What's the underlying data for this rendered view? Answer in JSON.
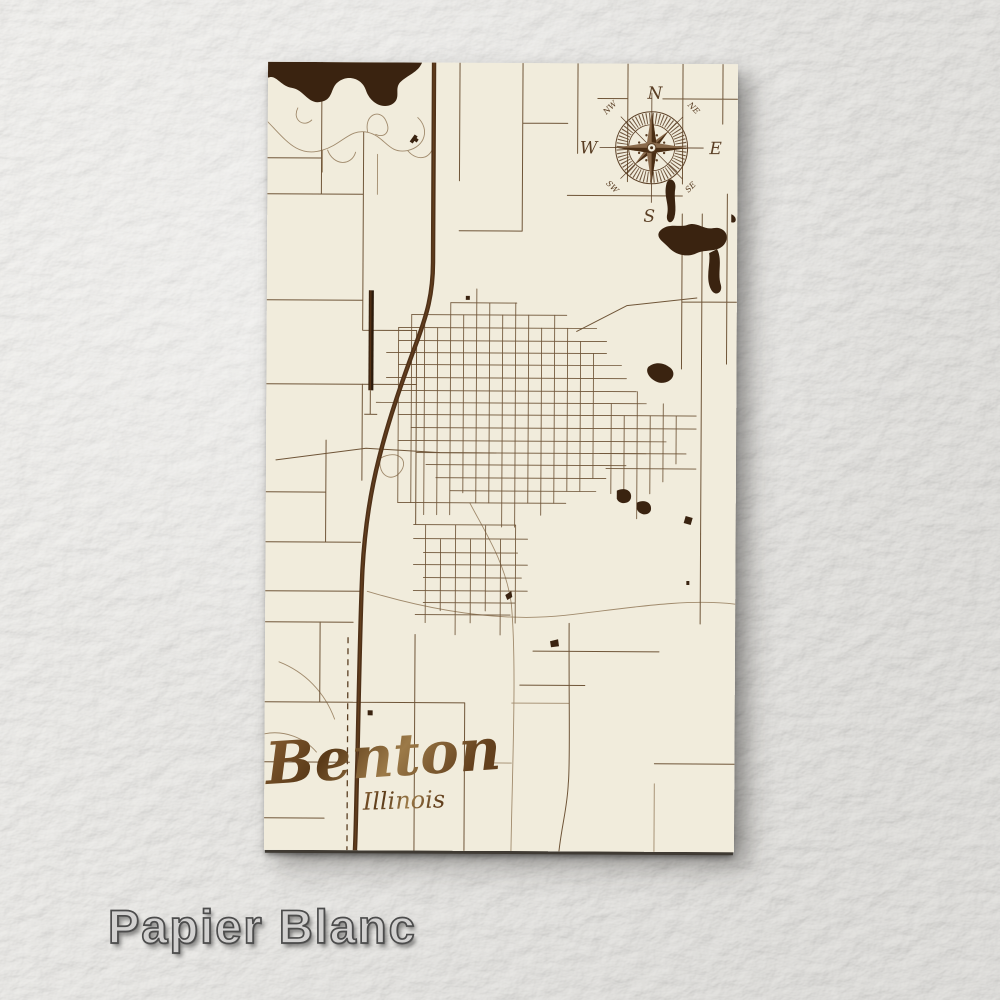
{
  "product": {
    "style_label": "Papier Blanc"
  },
  "map": {
    "title": "Benton",
    "subtitle": "Illinois",
    "compass": {
      "n": "N",
      "e": "E",
      "s": "S",
      "w": "W",
      "nw": "NW",
      "ne": "NE",
      "sw": "SW",
      "se": "SE"
    }
  },
  "colors": {
    "background_paper": "#e9e8e4",
    "poster_wood_cream": "#f1ecdc",
    "street_major": "#6f5538",
    "street_minor": "#a08a6c",
    "highway": "#4f3118",
    "water_dark_wood": "#3a2310",
    "runway": "#33200e",
    "engraving_title": "#6f4c28",
    "compass_ink": "#5a3e24",
    "watermark_fill": "#d2d1d0",
    "watermark_outline": "#4c4c4c"
  }
}
